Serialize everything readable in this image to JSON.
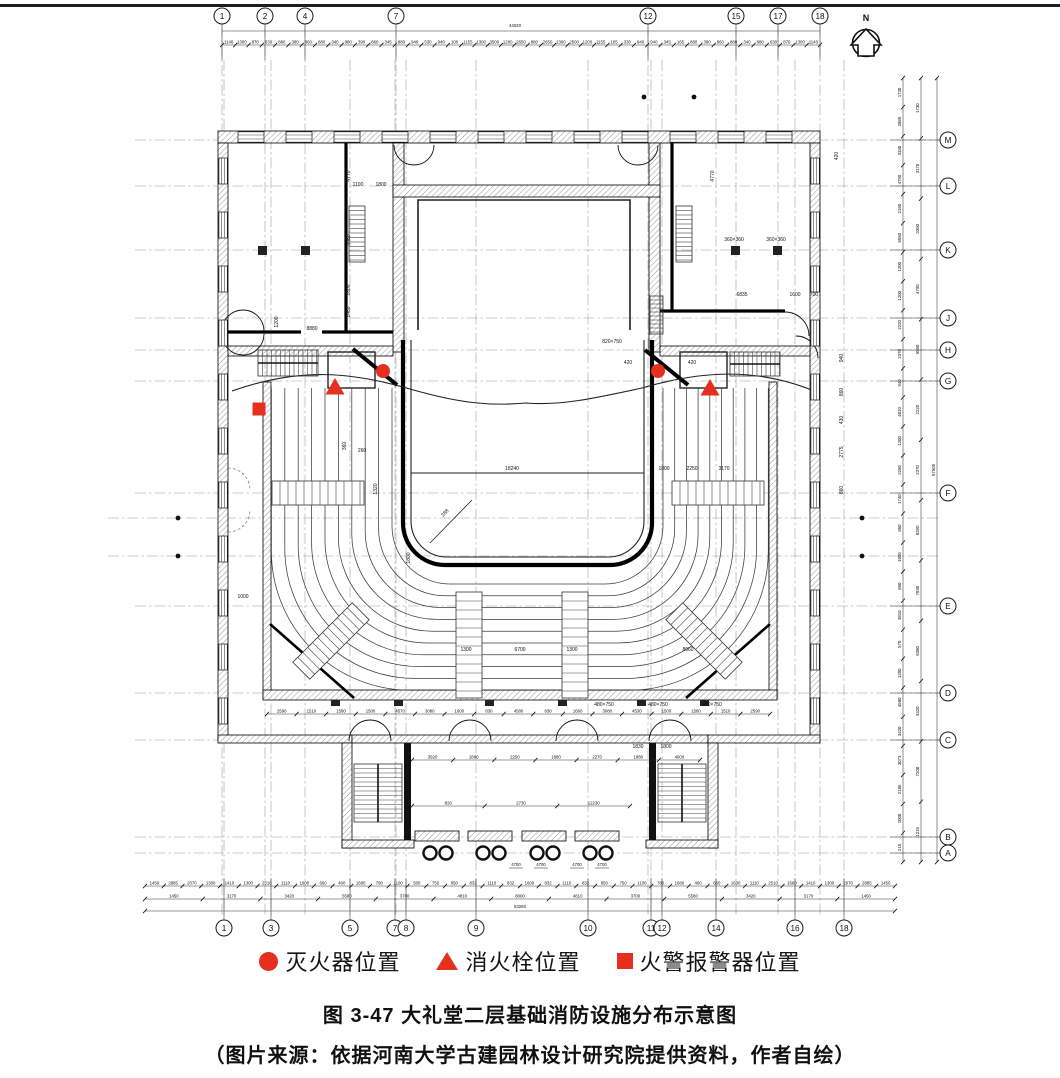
{
  "figure": {
    "caption": "图 3-47 大礼堂二层基础消防设施分布示意图",
    "source": "（图片来源：依据河南大学古建园林设计研究院提供资料，作者自绘）",
    "legend": {
      "symbol_color": "#e5301f",
      "items": [
        {
          "symbol": "circle",
          "label": "灭火器位置"
        },
        {
          "symbol": "triangle",
          "label": "消火栓位置"
        },
        {
          "symbol": "square",
          "label": "火警报警器位置"
        }
      ]
    }
  },
  "north_arrow": {
    "label": "N"
  },
  "grid": {
    "top": {
      "y": 16,
      "bubbles": [
        {
          "label": "1",
          "x": 222
        },
        {
          "label": "2",
          "x": 265
        },
        {
          "label": "4",
          "x": 305
        },
        {
          "label": "7",
          "x": 396
        },
        {
          "label": "12",
          "x": 648
        },
        {
          "label": "15",
          "x": 736
        },
        {
          "label": "17",
          "x": 778
        },
        {
          "label": "18",
          "x": 820
        }
      ]
    },
    "bottom": {
      "y": 928,
      "bubbles": [
        {
          "label": "1",
          "x": 224
        },
        {
          "label": "3",
          "x": 271
        },
        {
          "label": "5",
          "x": 350
        },
        {
          "label": "7",
          "x": 395
        },
        {
          "label": "8",
          "x": 406
        },
        {
          "label": "9",
          "x": 476
        },
        {
          "label": "10",
          "x": 588
        },
        {
          "label": "11",
          "x": 651
        },
        {
          "label": "12",
          "x": 662
        },
        {
          "label": "14",
          "x": 716
        },
        {
          "label": "16",
          "x": 795
        },
        {
          "label": "18",
          "x": 844
        }
      ]
    },
    "right": {
      "x": 948,
      "bubbles": [
        {
          "label": "M",
          "y": 140
        },
        {
          "label": "L",
          "y": 186
        },
        {
          "label": "K",
          "y": 250
        },
        {
          "label": "J",
          "y": 318
        },
        {
          "label": "H",
          "y": 350
        },
        {
          "label": "G",
          "y": 381
        },
        {
          "label": "F",
          "y": 493
        },
        {
          "label": "E",
          "y": 606
        },
        {
          "label": "D",
          "y": 693
        },
        {
          "label": "C",
          "y": 740
        },
        {
          "label": "B",
          "y": 837
        },
        {
          "label": "A",
          "y": 853
        }
      ]
    },
    "extra_horizontal_lines": [
      518,
      556
    ],
    "dots": [
      [
        644,
        97
      ],
      [
        694,
        97
      ],
      [
        178,
        518
      ],
      [
        178,
        556
      ],
      [
        862,
        518
      ],
      [
        862,
        556
      ]
    ]
  },
  "dimensions": {
    "top_total": {
      "text": "44020",
      "x": 515,
      "y": 27,
      "line_y": 31,
      "x0": 222,
      "x1": 820
    },
    "top_chain": {
      "y": 45,
      "x0": 222,
      "x1": 820,
      "values": [
        "1140",
        "1300",
        "870",
        "630",
        "880",
        "380",
        "860",
        "880",
        "340",
        "880",
        "390",
        "860",
        "345",
        "880",
        "940",
        "530",
        "940",
        "100",
        "1155",
        "1300",
        "3500",
        "1200",
        "2650",
        "880",
        "2650",
        "1300",
        "2500",
        "1200",
        "1155",
        "165",
        "330",
        "940",
        "940",
        "345",
        "165",
        "880",
        "380",
        "860",
        "880",
        "340",
        "880",
        "630",
        "870",
        "1300",
        "1140"
      ]
    },
    "bottom_row1": {
      "y": 886,
      "x0": 145,
      "x1": 895,
      "values": [
        "1450",
        "2885",
        "2070",
        "1300",
        "1410",
        "1300",
        "2510",
        "1110",
        "1900",
        "660",
        "400",
        "1680",
        "790",
        "1100",
        "500",
        "750",
        "850",
        "832",
        "1110",
        "832",
        "1600",
        "832",
        "1110",
        "832",
        "850",
        "750",
        "1100",
        "780",
        "1680",
        "400",
        "660",
        "1600",
        "1110",
        "2510",
        "1660",
        "1410",
        "1300",
        "2070",
        "2885",
        "1450"
      ]
    },
    "bottom_row2": {
      "y": 899,
      "x0": 145,
      "x1": 895,
      "values": [
        "1450",
        "3170",
        "3420",
        "5580",
        "3700",
        "4810",
        "8000",
        "4810",
        "3700",
        "5580",
        "3420",
        "3170",
        "1450"
      ]
    },
    "bottom_total": {
      "text": "53280",
      "x": 520,
      "y": 908,
      "line_y": 911,
      "x0": 145,
      "x1": 895
    },
    "inner_chain": {
      "y": 714,
      "x0": 267,
      "x1": 770,
      "values": [
        "2590",
        "1510",
        "1580",
        "1500",
        "4570",
        "3080",
        "1600",
        "830",
        "4580",
        "830",
        "1660",
        "3080",
        "4530",
        "1500",
        "1580",
        "1510",
        "2590"
      ]
    },
    "lobby_row1": {
      "y": 760,
      "x0": 412,
      "x1": 700,
      "values": [
        "3920",
        "1880",
        "2250",
        "1880",
        "2270",
        "1880",
        "4000"
      ]
    },
    "lobby_row2": {
      "y": 806,
      "x0": 412,
      "x1": 630,
      "values": [
        "820",
        "2730",
        "12230"
      ]
    },
    "porch_labels": {
      "y": 866,
      "xs": [
        516,
        541,
        577,
        602
      ],
      "text": "4700"
    },
    "right_col1": {
      "x": 903,
      "y0": 78,
      "y1": 862,
      "values": [
        "1730",
        "2885",
        "3330",
        "4790",
        "2160",
        "5550",
        "1200",
        "1200",
        "2220",
        "2370",
        "940",
        "4810",
        "1200",
        "2250",
        "1740",
        "850",
        "1800",
        "850",
        "3810",
        "570",
        "1200",
        "4580",
        "3420",
        "3073",
        "2185",
        "1000",
        "215"
      ]
    },
    "right_col2": {
      "x": 921,
      "y0": 78,
      "y1": 862,
      "values": [
        "1730",
        "3170",
        "3350",
        "4790",
        "5550",
        "2220",
        "2370",
        "8390",
        "7630",
        "6380",
        "3420",
        "7200",
        "1215"
      ]
    },
    "right_total": {
      "x": 937,
      "y0": 78,
      "y1": 862,
      "values": [
        "57505"
      ]
    },
    "annotations": [
      {
        "t": "4770",
        "x": 350,
        "y": 176,
        "r": -90
      },
      {
        "t": "4480",
        "x": 350,
        "y": 240,
        "r": -90
      },
      {
        "t": "1600",
        "x": 350,
        "y": 290,
        "r": -90
      },
      {
        "t": "1480",
        "x": 350,
        "y": 312,
        "r": -90
      },
      {
        "t": "1100",
        "x": 358,
        "y": 186
      },
      {
        "t": "1800",
        "x": 381,
        "y": 186
      },
      {
        "t": "8880",
        "x": 312,
        "y": 330
      },
      {
        "t": "1200",
        "x": 278,
        "y": 322,
        "r": -90
      },
      {
        "t": "4770",
        "x": 714,
        "y": 176,
        "r": -90
      },
      {
        "t": "6835",
        "x": 742,
        "y": 296
      },
      {
        "t": "1600",
        "x": 795,
        "y": 296
      },
      {
        "t": "700",
        "x": 814,
        "y": 296
      },
      {
        "t": "360×360",
        "x": 734,
        "y": 241
      },
      {
        "t": "360×360",
        "x": 776,
        "y": 241
      },
      {
        "t": "420",
        "x": 838,
        "y": 156,
        "r": -90
      },
      {
        "t": "820×750",
        "x": 612,
        "y": 343
      },
      {
        "t": "420",
        "x": 628,
        "y": 364
      },
      {
        "t": "420",
        "x": 692,
        "y": 364
      },
      {
        "t": "18240",
        "x": 512,
        "y": 470
      },
      {
        "t": "1800",
        "x": 664,
        "y": 470
      },
      {
        "t": "2250",
        "x": 692,
        "y": 470
      },
      {
        "t": "3170",
        "x": 724,
        "y": 470
      },
      {
        "t": "1320",
        "x": 377,
        "y": 489,
        "r": -90
      },
      {
        "t": "360",
        "x": 346,
        "y": 446,
        "r": -90
      },
      {
        "t": "260",
        "x": 362,
        "y": 452
      },
      {
        "t": "288",
        "x": 446,
        "y": 514,
        "r": -45
      },
      {
        "t": "1800",
        "x": 410,
        "y": 558,
        "r": -90
      },
      {
        "t": "1300",
        "x": 466,
        "y": 651
      },
      {
        "t": "6700",
        "x": 520,
        "y": 651
      },
      {
        "t": "1300",
        "x": 572,
        "y": 651
      },
      {
        "t": "8060",
        "x": 688,
        "y": 651
      },
      {
        "t": "480×750",
        "x": 604,
        "y": 706
      },
      {
        "t": "480×750",
        "x": 658,
        "y": 706
      },
      {
        "t": "480×750",
        "x": 712,
        "y": 706
      },
      {
        "t": "940",
        "x": 843,
        "y": 358,
        "r": -90
      },
      {
        "t": "860",
        "x": 843,
        "y": 392,
        "r": -90
      },
      {
        "t": "430",
        "x": 843,
        "y": 420,
        "r": -90
      },
      {
        "t": "2775",
        "x": 843,
        "y": 452,
        "r": -90
      },
      {
        "t": "860",
        "x": 843,
        "y": 490,
        "r": -90
      },
      {
        "t": "1000",
        "x": 243,
        "y": 598
      },
      {
        "t": "1830",
        "x": 638,
        "y": 748
      },
      {
        "t": "1800",
        "x": 666,
        "y": 748
      }
    ]
  },
  "fire_markers": {
    "color": "#e5301f",
    "extinguishers": [
      [
        383,
        371
      ],
      [
        658,
        371
      ]
    ],
    "hydrants": [
      [
        335,
        387
      ],
      [
        710,
        388
      ]
    ],
    "alarms": [
      [
        259,
        409
      ]
    ]
  }
}
